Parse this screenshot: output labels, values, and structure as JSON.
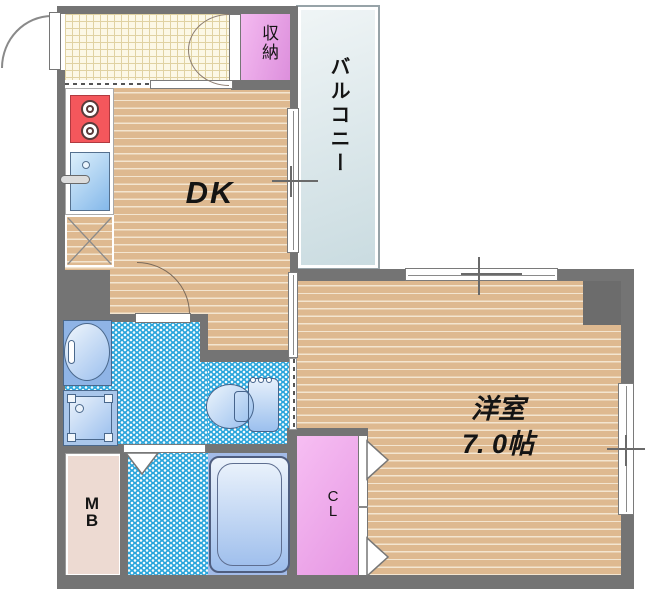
{
  "floorplan": {
    "rooms": {
      "dk": {
        "label": "DK"
      },
      "western_room": {
        "label": "洋室",
        "size": "7. 0帖"
      },
      "balcony": {
        "label": "バルコニー"
      },
      "storage": {
        "label": "収納"
      },
      "closet": {
        "letters": [
          "C",
          "L"
        ]
      },
      "meter_box": {
        "letters": [
          "M",
          "B"
        ]
      }
    },
    "colors": {
      "wall": "#747474",
      "wood_floor": "#DEB990",
      "tile_blue": "#29A5DB",
      "genkan_tile": "#FCF8E6",
      "storage_pink": "#E9A2E6",
      "closet_pink": "#F2B0EE",
      "balcony_gray_blue": "#DDE8EC",
      "meter_box_beige": "#EDDAD2",
      "stove_red": "#F4575C",
      "fixture_blue": "#A9C6EA"
    }
  }
}
